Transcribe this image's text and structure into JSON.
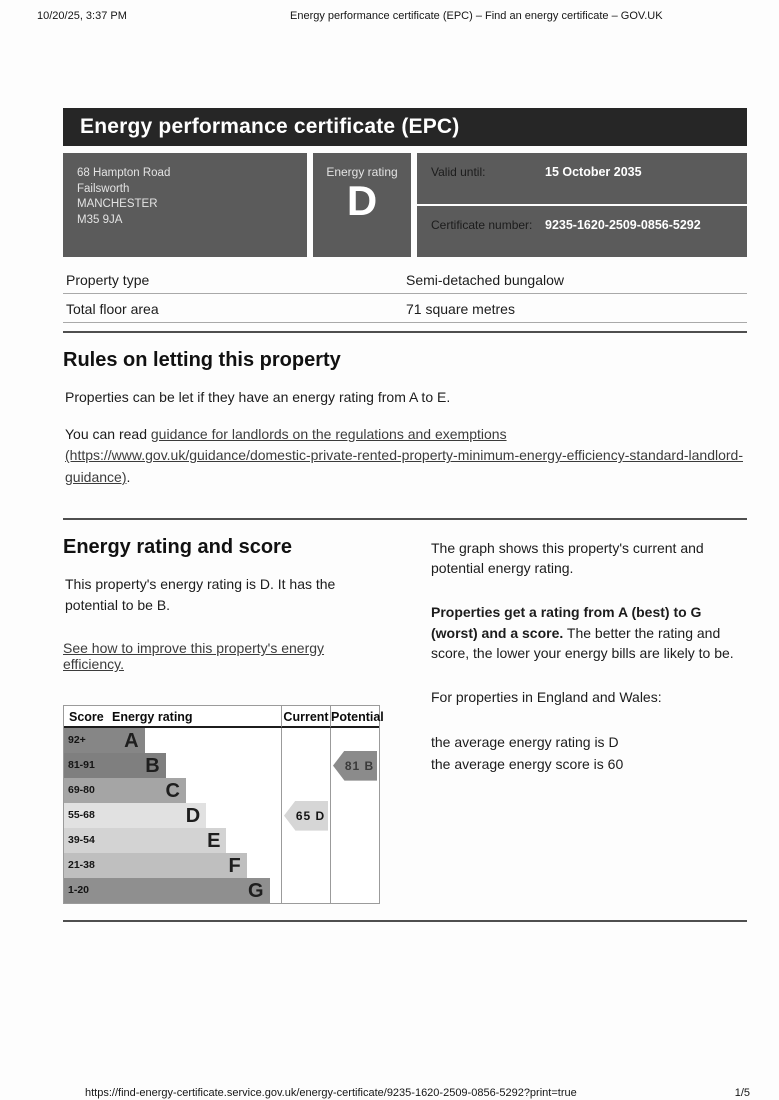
{
  "print_chrome": {
    "datetime": "10/20/25, 3:37 PM",
    "title": "Energy performance certificate (EPC) – Find an energy certificate – GOV.UK",
    "url": "https://find-energy-certificate.service.gov.uk/energy-certificate/9235-1620-2509-0856-5292?print=true",
    "page_indicator": "1/5"
  },
  "banner": {
    "title": "Energy performance certificate (EPC)"
  },
  "summary_card": {
    "address_lines": [
      "68 Hampton Road",
      "Failsworth",
      "MANCHESTER",
      "M35 9JA"
    ],
    "energy_rating_label": "Energy rating",
    "energy_rating_value": "D",
    "valid_until_label": "Valid until:",
    "valid_until_value": "15 October 2035",
    "certificate_number_label": "Certificate number:",
    "certificate_number_value": "9235-1620-2509-0856-5292"
  },
  "property_facts": {
    "rows": [
      {
        "label": "Property type",
        "value": "Semi-detached bungalow"
      },
      {
        "label": "Total floor area",
        "value": "71 square metres"
      }
    ]
  },
  "letting_rules": {
    "heading": "Rules on letting this property",
    "paragraph1": "Properties can be let if they have an energy rating from A to E.",
    "paragraph2_prefix": "You can read ",
    "link_text": "guidance for landlords on the regulations and exemptions (https://www.gov.uk/guidance/domestic-private-rented-property-minimum-energy-efficiency-standard-landlord-guidance)",
    "paragraph2_suffix": "."
  },
  "rating_section": {
    "heading": "Energy rating and score",
    "paragraph1": "This property's energy rating is D. It has the potential to be B.",
    "improve_link_text": "See how to improve this property's energy efficiency.",
    "right_paragraph1": "The graph shows this property's current and potential energy rating.",
    "right_bold": "Properties get a rating from A (best) to G (worst) and a score.",
    "right_after_bold": " The better the rating and score, the lower your energy bills are likely to be.",
    "right_paragraph3": "For properties in England and Wales:",
    "right_line1": "the average energy rating is D",
    "right_line2": "the average energy score is 60"
  },
  "chart_data": {
    "type": "bar",
    "title": "Energy rating and score graph",
    "columns": [
      "Score",
      "Energy rating",
      "Current",
      "Potential"
    ],
    "legend_position": "header-row",
    "bands": [
      {
        "letter": "A",
        "score": "92+",
        "color": "#868686",
        "bar_fraction": 0.225
      },
      {
        "letter": "B",
        "score": "81-91",
        "color": "#7f7f7f",
        "bar_fraction": 0.345
      },
      {
        "letter": "C",
        "score": "69-80",
        "color": "#a5a5a5",
        "bar_fraction": 0.46
      },
      {
        "letter": "D",
        "score": "55-68",
        "color": "#e1e1e1",
        "bar_fraction": 0.575
      },
      {
        "letter": "E",
        "score": "39-54",
        "color": "#d3d3d3",
        "bar_fraction": 0.69
      },
      {
        "letter": "F",
        "score": "21-38",
        "color": "#bfbfbf",
        "bar_fraction": 0.805
      },
      {
        "letter": "G",
        "score": "1-20",
        "color": "#8f8f8f",
        "bar_fraction": 0.935
      }
    ],
    "current": {
      "label": "65 D",
      "score": 65,
      "letter": "D",
      "band_index": 3,
      "arrow_color": "#d6d6d6",
      "text_color": "#141414"
    },
    "potential": {
      "label": "81 B",
      "score": 81,
      "letter": "B",
      "band_index": 1,
      "arrow_color": "#8b8b8b",
      "text_color": "#3a3a3a"
    }
  }
}
